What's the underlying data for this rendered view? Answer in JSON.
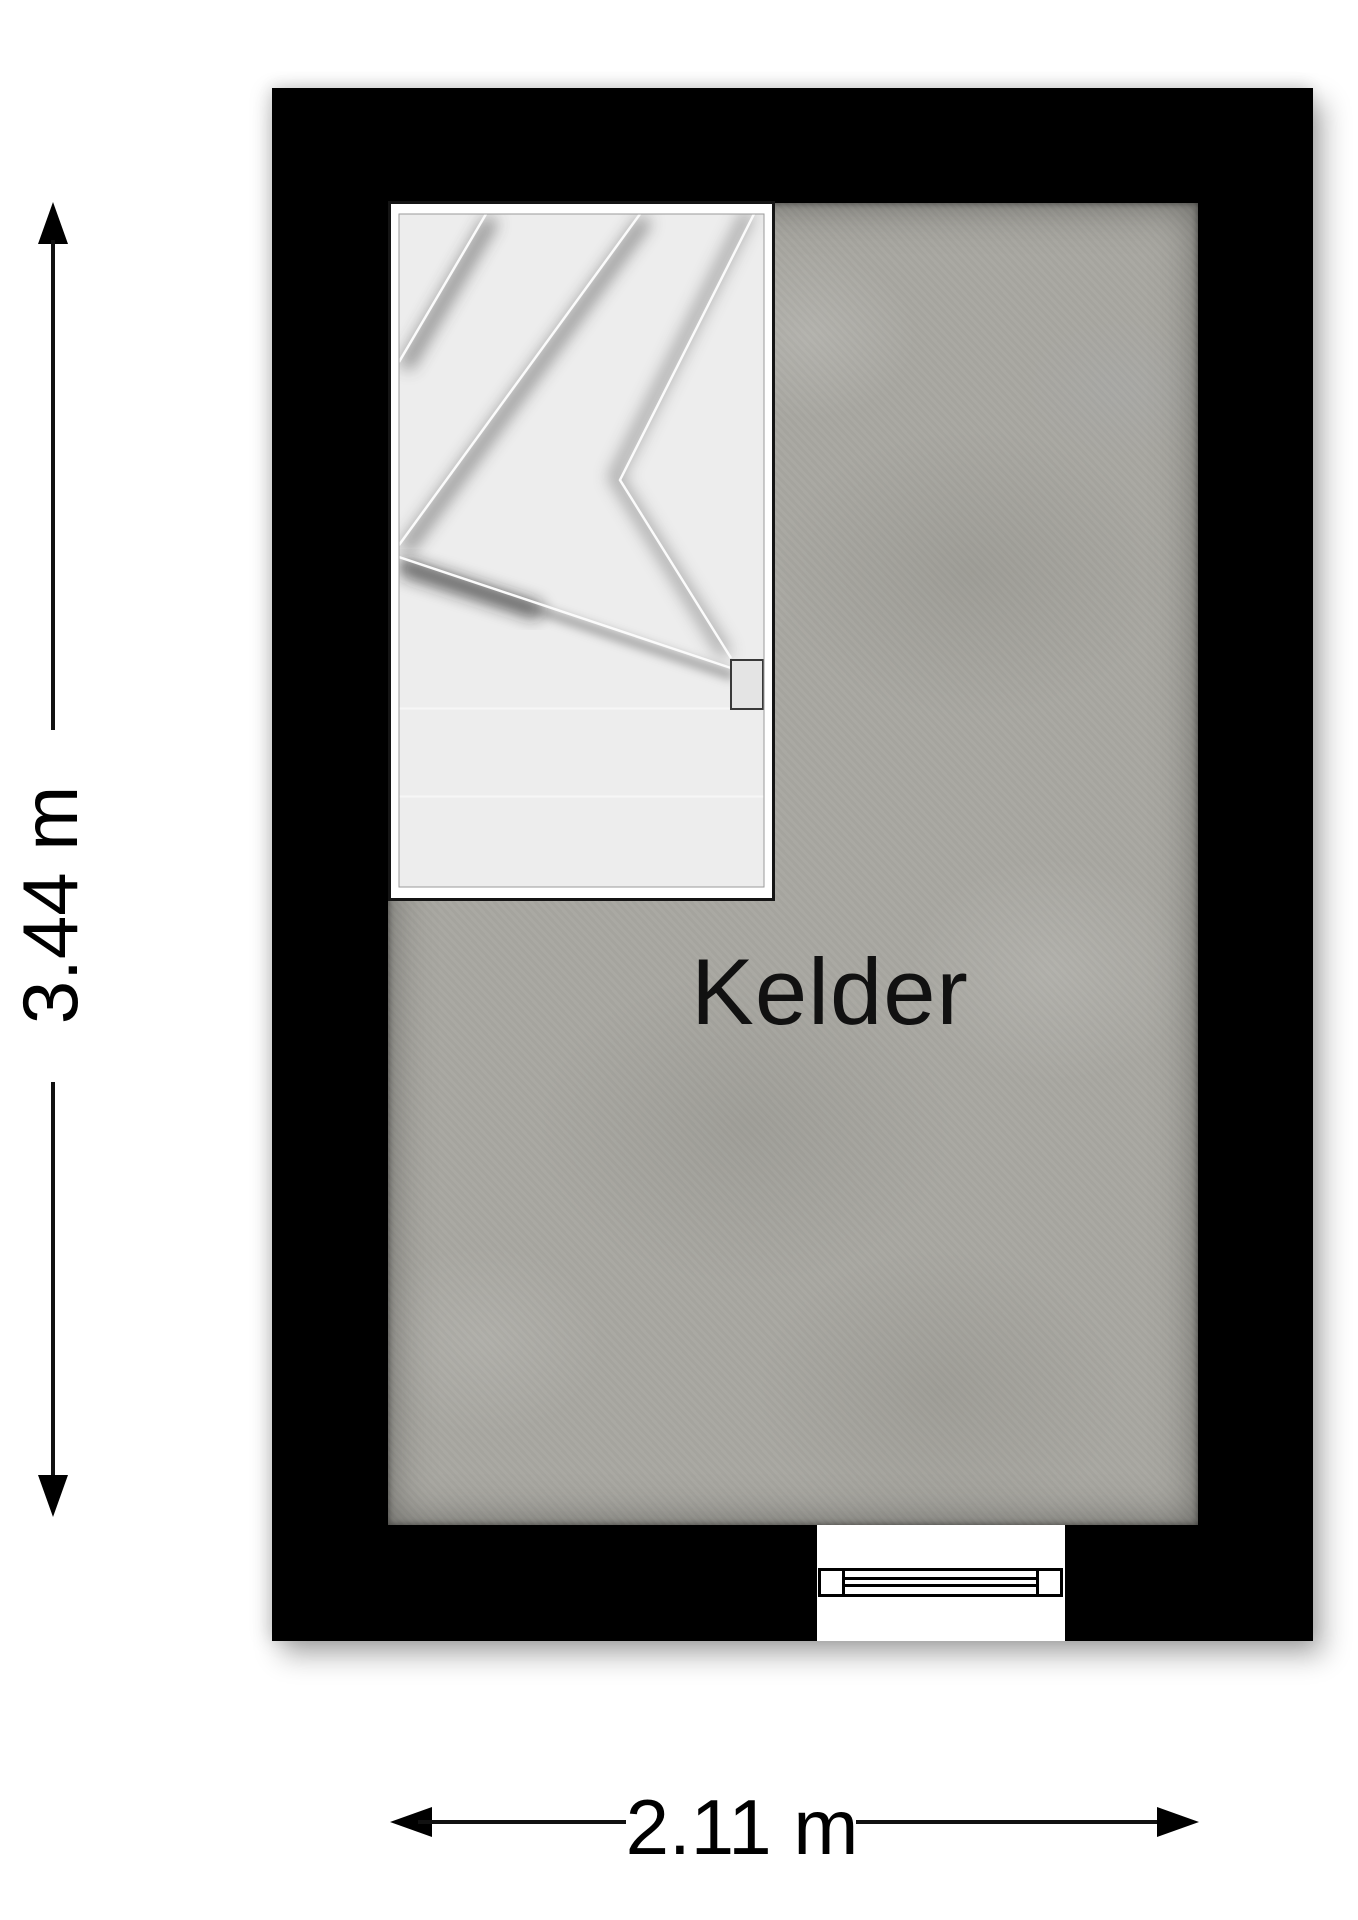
{
  "floorplan": {
    "room_label": "Kelder",
    "dimension_vertical": "3.44 m",
    "dimension_horizontal": "2.11 m"
  },
  "colors": {
    "wall": "#000000",
    "floor_base": "#a8a7a1",
    "stair_tread": "#ededed",
    "stair_wall": "#ffffff",
    "dimension": "#000000",
    "background": "#ffffff"
  },
  "icons": {
    "vertical_dimension_arrows": [
      "arrow-up-icon",
      "arrow-down-icon"
    ],
    "horizontal_dimension_arrows": [
      "arrow-left-icon",
      "arrow-right-icon"
    ]
  }
}
